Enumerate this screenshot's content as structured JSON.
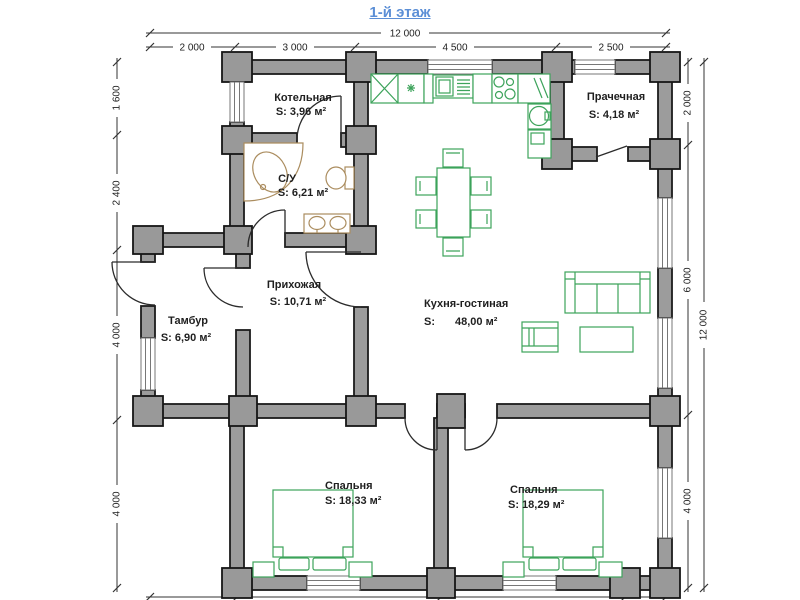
{
  "title": "1-й этаж",
  "dimensions": {
    "top_total": "12 000",
    "top_segments": [
      "2 000",
      "3 000",
      "4 500",
      "2 500"
    ],
    "left": [
      "1 600",
      "2 400",
      "4 000",
      "4 000"
    ],
    "right_inner": [
      "2 000",
      "6 000",
      "4 000"
    ],
    "right_total": "12 000"
  },
  "rooms": {
    "boiler": {
      "name": "Котельная",
      "area": "S: 3,96 м²"
    },
    "bathroom": {
      "name": "С/У",
      "area": "S: 6,21 м²"
    },
    "laundry": {
      "name": "Прачечная",
      "area": "S: 4,18 м²"
    },
    "kitchen_living": {
      "name": "Кухня-гостиная",
      "area_label": "S:",
      "area_value": "48,00 м²"
    },
    "hallway": {
      "name": "Прихожая",
      "area": "S: 10,71 м²"
    },
    "vestibule": {
      "name": "Тамбур",
      "area": "S: 6,90 м²"
    },
    "bedroom_left": {
      "name": "Спальня",
      "area": "S: 18,33 м²"
    },
    "bedroom_right": {
      "name": "Спальня",
      "area": "S: 18,29 м²"
    }
  },
  "colors": {
    "wall_fill": "#9c9c9c",
    "wall_outline": "#1c1c1c",
    "furniture_green": "#3da35b",
    "sanitary_tan": "#ab8d5f",
    "title_blue": "#5c8fd6",
    "dimension_text": "#1f1f1f"
  }
}
